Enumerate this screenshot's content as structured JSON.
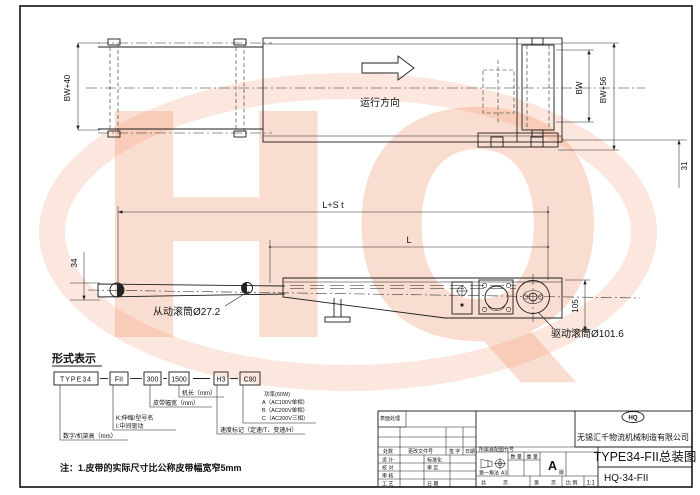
{
  "watermark": "HQ",
  "top_view": {
    "dim_bw40": "BW+40",
    "dim_bw": "BW",
    "dim_bw56": "BW+56",
    "dim_31": "31",
    "direction_label": "运行方向"
  },
  "side_view": {
    "dim_l_st": "L+S t",
    "dim_l": "L",
    "dim_34": "34",
    "dim_105": "105",
    "driven_roller_label": "从动滚筒Ø27.2",
    "drive_roller_label": "驱动滚筒Ø101.6"
  },
  "type_designation": {
    "heading": "形式表示",
    "boxes": [
      "TYPE34",
      "FII",
      "300",
      "1500",
      "H3",
      "C90"
    ],
    "labels": {
      "frame_height": "数字/机架高（mm）",
      "k_option": "K:伸缩/型号名",
      "i_option": "I:中间驱动",
      "belt_width": "皮带幅宽（mm）",
      "machine_length": "机长（mm）",
      "speed_mark": "速度标记（定速/T、变速/H）",
      "power": "功率(60W)",
      "power_a": "A（AC100V单相）",
      "power_b": "B（AC200V单相）",
      "power_c": "C（AC200V三相）"
    },
    "note": "注：1.皮带的实际尺寸比公称皮带幅宽窄5mm"
  },
  "title_block": {
    "surface_treatment": "表面处理",
    "header_cols": [
      "处数",
      "更改文件号",
      "签 字",
      "日期"
    ],
    "sig_rows": [
      {
        "l": "设 计",
        "r": "标准化"
      },
      {
        "l": "校 对",
        "r": "审 定"
      },
      {
        "l": "审 核",
        "r": ""
      },
      {
        "l": "工 艺",
        "r": "日 期"
      }
    ],
    "belongs_code": "所属装配图代号",
    "projection": "第一角法",
    "sheet_size": "A3",
    "quantity": "数 量",
    "weight": "重 量",
    "rev": "A",
    "rev_suffix": "版",
    "total_label": "共",
    "page_label": "页",
    "no_label": "第",
    "page_label2": "页",
    "scale_label": "比 例",
    "scale_value": "1:1",
    "logo_text": "HQ",
    "company": "无锡汇千物流机械制造有限公司",
    "title": "TYPE34-FII总装图",
    "drawing_no": "HQ-34-FII"
  }
}
